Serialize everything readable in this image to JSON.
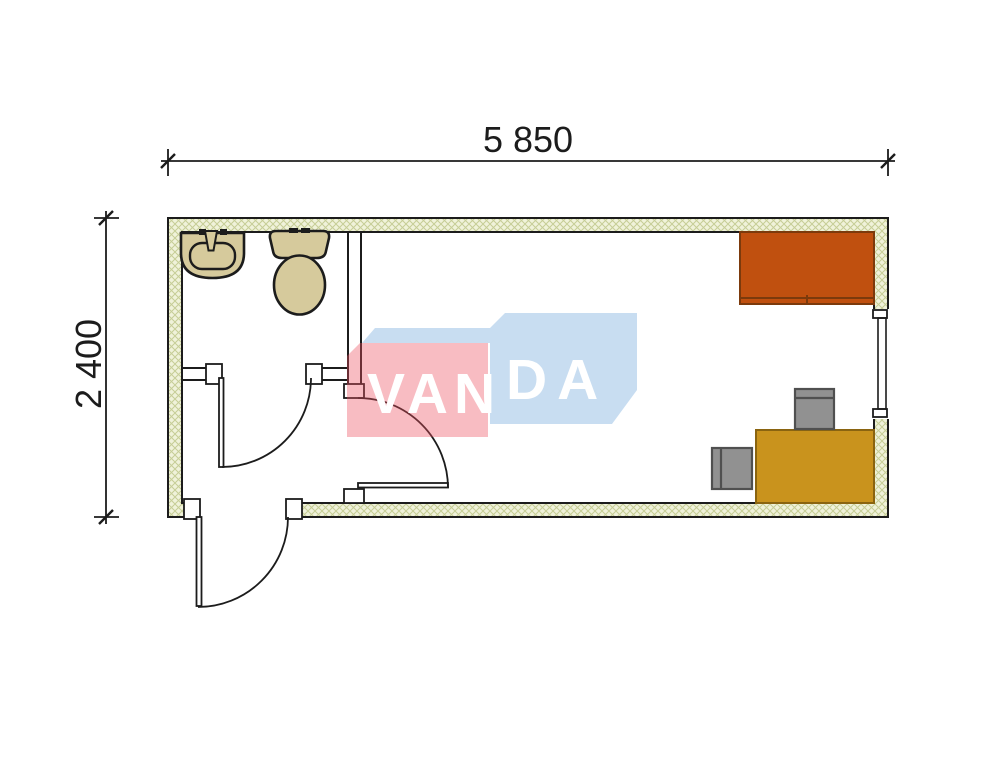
{
  "dimensions": {
    "width_label": "5 850",
    "height_label": "2 400"
  },
  "watermark": {
    "text": "VANDA",
    "left_text": "VAN",
    "right_text": "DA",
    "text_color": "#ffffff",
    "red_block_color": "rgba(236,80,95,0.38)",
    "blue_block_color": "rgba(125,175,221,0.42)"
  },
  "colors": {
    "background": "#ffffff",
    "line": "#1c1c1c",
    "hatch_bg": "#f0f2da",
    "hatch_line": "#c6cd96",
    "fixture": "#d6ca9c",
    "bed": "#c0500f",
    "bed_edge": "#7c3a0c",
    "desk": "#c9931d",
    "desk_edge": "#8a6410",
    "chair": "#919191",
    "chair_edge": "#505050"
  },
  "objects": [
    "sink",
    "toilet",
    "bed",
    "desk",
    "chair",
    "chair",
    "window",
    "entrance-door",
    "bathroom-door",
    "room-door"
  ]
}
